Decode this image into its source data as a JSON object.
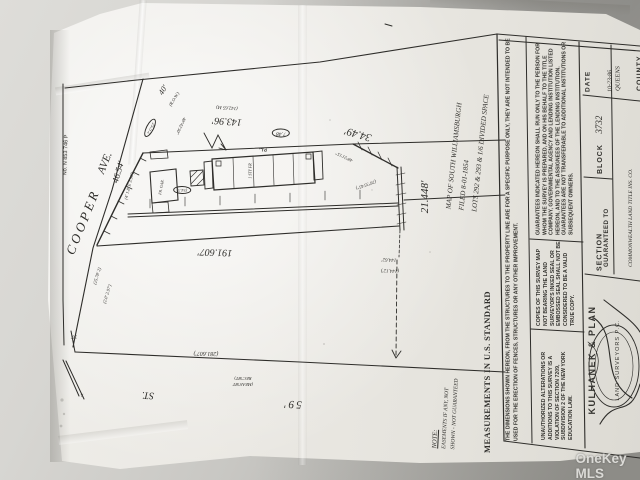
{
  "watermark": "OneKey MLS",
  "drawing": {
    "file_no": "No. N 853 746 P",
    "street_cooper": "COOPER",
    "street_cooper_suffix": "AVE.",
    "road_width": "40'",
    "road_note": "(R.O.W.)",
    "street_59_num": "59'",
    "street_59_st": "ST.",
    "dim_frontage": "46.54'",
    "dim_rear": "143.96'",
    "dim_rear_alt": "(142.65 M)",
    "dim_angle": "34.49'",
    "dim_end": "21.448'",
    "dim_front": "191.607'",
    "dim_street": "(281.607')",
    "dim_tie": "144.62'",
    "dim_tie_alt": "(144.12')",
    "bearing_1": "40°42'30\"",
    "bearing_2": "48°21'15\"",
    "bearing_3": "(26°35'45\")",
    "circle_1": "25.5'2",
    "circle_2": "7.48",
    "circle_3": "(54.3)",
    "pl_mark": "P.L.",
    "corner_mark": "x",
    "corner_dim": "30'",
    "scribble_1": "(4' 1.8' E 3.96')",
    "scribble_2": "(25.78' 2)",
    "scribble_3": "(2.0' 2.97')",
    "meas_note_1": "(MEAS'MT",
    "meas_note_2": "REC'MT)",
    "bldg_garage": "FR. GAR.",
    "bldg_main": "1 STY FR",
    "map_note_1": "MAP OF SOUTH WILLIAMSBURGH",
    "map_note_2": "FILED 8-01-1854",
    "map_note_3": "LOTS 292 & 293 & 1/6 DIVIDED SPACE",
    "note_title": "NOTE:",
    "note_line1": "EASEMENTS IF ANY, NOT",
    "note_line2": "SHOWN - NOT GUARANTEED",
    "standard": "MEASUREMENTS IN U.S. STANDARD"
  },
  "title_block": {
    "disclaimer": "THE DIMENSIONS SHOWN HEREON, FROM THE STRUCTURES TO THE PROPERTY LINE ARE FOR A SPECIFIC PURPOSE ONLY, THEY ARE NOT INTENDED TO BE USED FOR THE ERECTION OF FENCES, STRUCTURES OR ANY OTHER IMPROVEMENT.",
    "guarantee": "GUARANTEES INDICATED HEREON SHALL RUN ONLY TO THE PERSON FOR WHOM THE SURVEY IS PREPARED, AND ON HIS BEHALF TO THE TITLE COMPANY, GOVERNMENTAL AGENCY AND LENDING INSTITUTION LISTED HEREON, AND TO THE ASSIGNEES OF THE LENDING INSTITUTION. GUARANTEES ARE NOT TRANSFERABLE TO ADDITIONAL INSTITUTIONS OR SUBSEQUENT OWNERS.",
    "copies": "COPIES OF THIS SURVEY MAP NOT BEARING THE LAND SURVEYOR'S INKED SEAL OR EMBOSSED SEAL SHALL NOT BE CONSIDERED TO BE A VALID TRUE COPY.",
    "alterations": "UNAUTHORIZED ALTERATIONS OR ADDITIONS TO THIS SURVEY IS A VIOLATION OF SECTION 7209, SUBDIVISION 2 OF THE NEW YORK EDUCATION LAW.",
    "date_label": "DATE",
    "date_value": "10-23-86",
    "county_value": "QUEENS",
    "county_label": "COUNTY",
    "block_label": "BLOCK",
    "block_value": "3732",
    "section_label": "SECTION",
    "guaranteed_label": "GUARANTEED TO",
    "guaranteed_line1": "COMMONWEALTH LAND TITLE INS. CO.",
    "guaranteed_line2": "MORTGAGEE CO. INC.",
    "surveyor_name": "KULHANEK & PLAN",
    "surveyor_sub": "LAND SURVEYORS P.C."
  }
}
